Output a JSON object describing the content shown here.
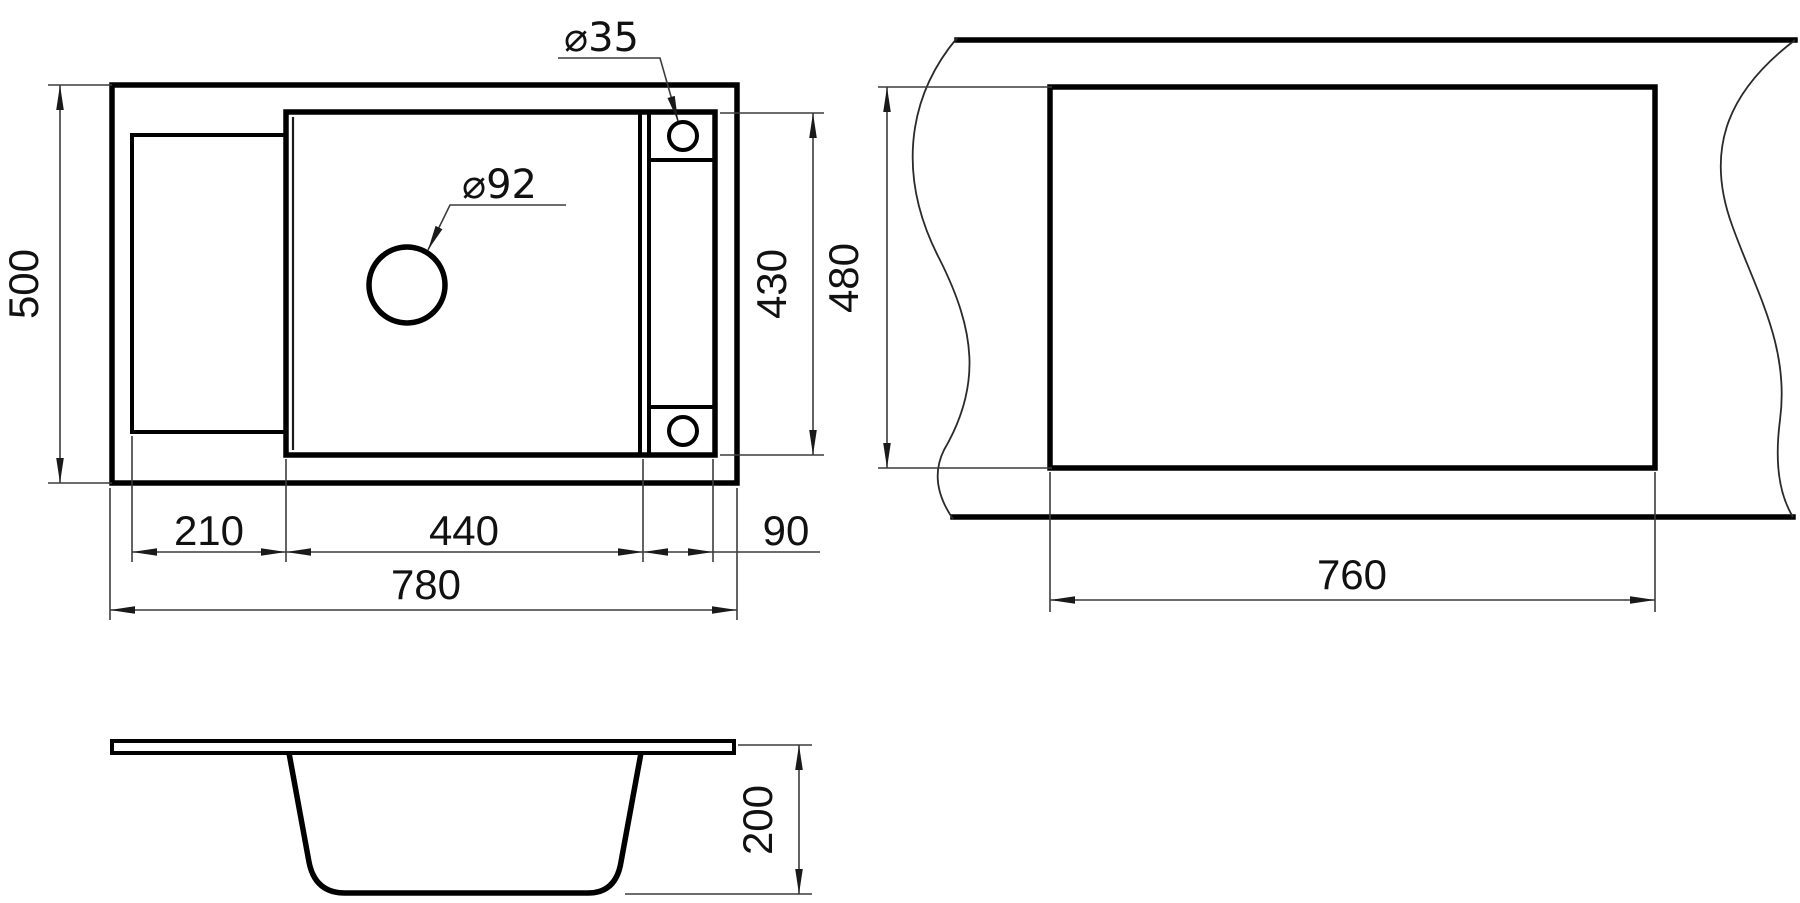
{
  "views": {
    "plan": {
      "dim_height_total": "500",
      "dim_drainboard_width": "210",
      "dim_bowl_width": "440",
      "dim_ledge_width": "90",
      "dim_width_total": "780",
      "dim_bowl_height": "430",
      "label_faucet_hole_diameter": "⌀35",
      "label_drain_hole_diameter": "⌀92"
    },
    "cutout": {
      "dim_cutout_height": "480",
      "dim_cutout_width": "760"
    },
    "section": {
      "dim_bowl_depth": "200"
    }
  },
  "colors": {
    "line": "#000000",
    "dim_line": "#3c3c3c",
    "text": "#111111",
    "background": "#ffffff"
  }
}
